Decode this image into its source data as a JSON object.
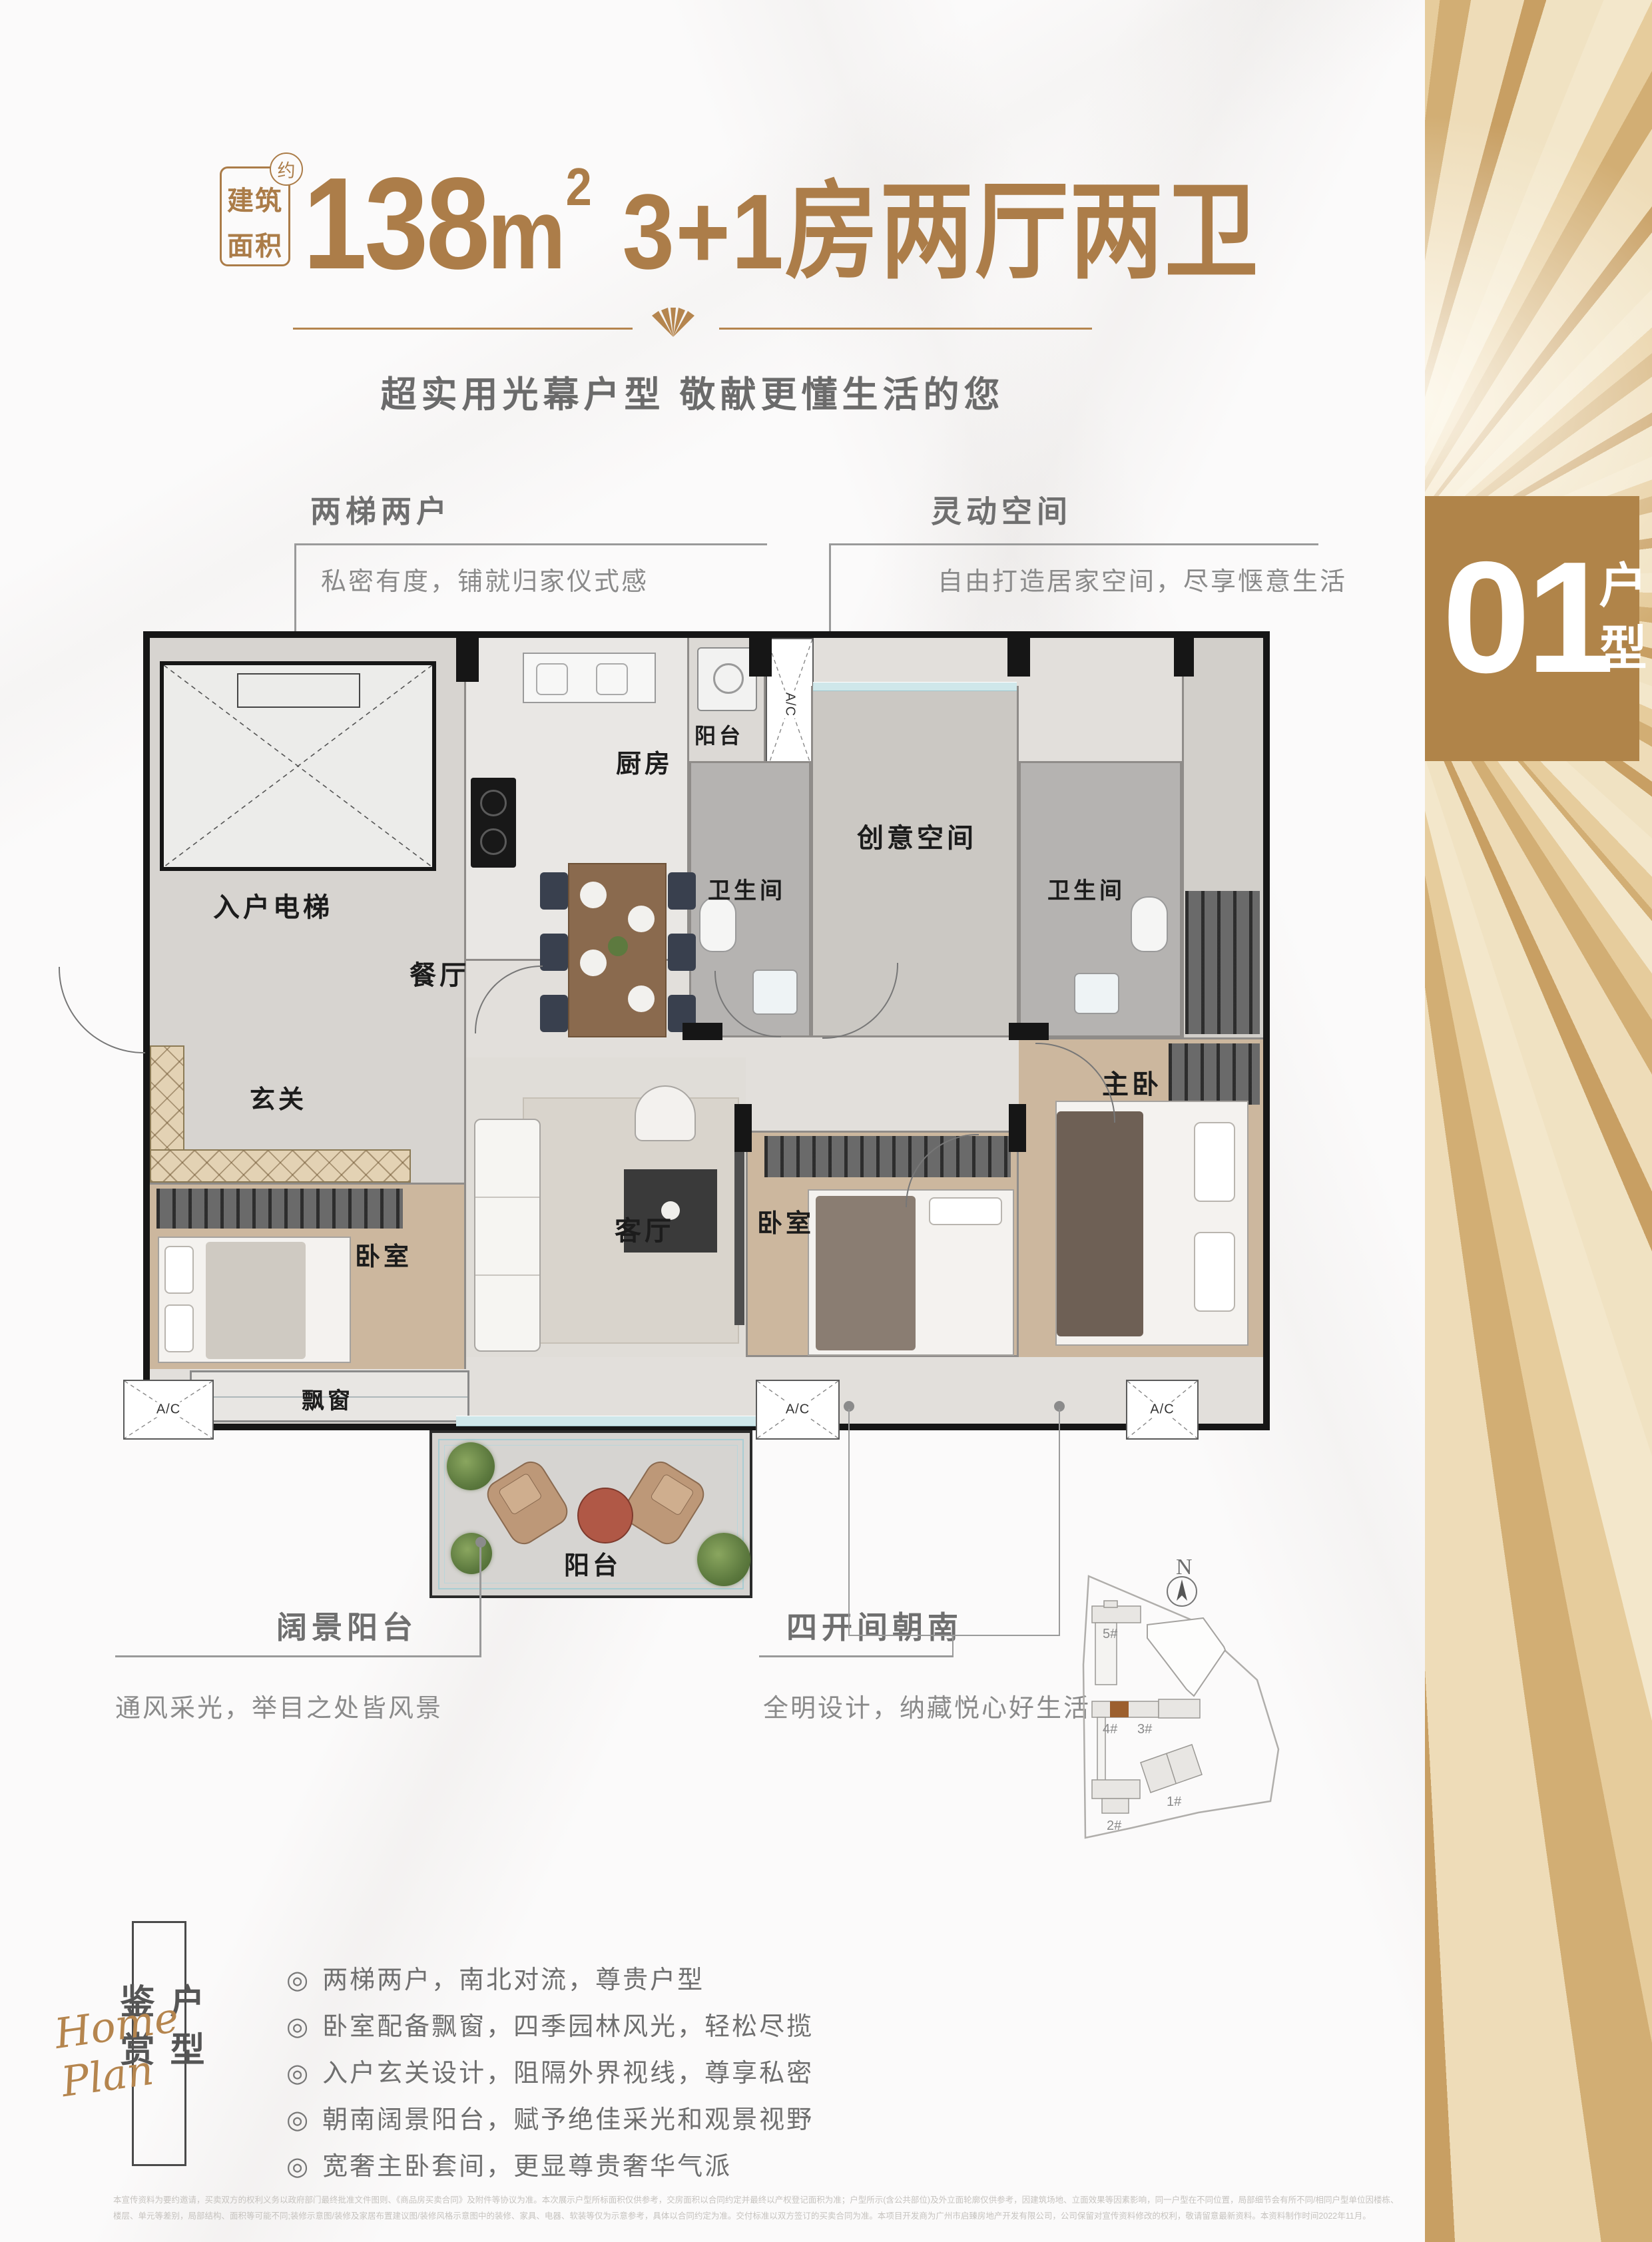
{
  "colors": {
    "accent": "#ab7c48",
    "tag_bg": "#b08449",
    "callout_title": "#6f6f6f",
    "callout_desc": "#8a8a8a",
    "site_highlight": "#9c5f2e",
    "wall": "#161616"
  },
  "header": {
    "badge_line1": "建筑",
    "badge_line2": "面积",
    "badge_approx": "约",
    "area_number": "138",
    "area_unit": "m",
    "area_sup": "2",
    "layout_text": "3+1房两厅两卫",
    "subtitle": "超实用光幕户型 敬献更懂生活的您"
  },
  "callouts": {
    "elevator": {
      "title": "两梯两户",
      "desc": "私密有度，铺就归家仪式感"
    },
    "flex": {
      "title": "灵动空间",
      "desc": "自由打造居家空间，尽享惬意生活"
    },
    "view_balcony": {
      "title": "阔景阳台",
      "desc": "通风采光，举目之处皆风景"
    },
    "south": {
      "title": "四开间朝南",
      "desc": "全明设计，纳藏悦心好生活"
    }
  },
  "plan": {
    "rooms": {
      "entrance_elevator": "入户电梯",
      "kitchen": "厨房",
      "balcony": "阳台",
      "bathroom": "卫生间",
      "creative": "创意空间",
      "foyer": "玄关",
      "dining": "餐厅",
      "living": "客厅",
      "bedroom": "卧室",
      "master": "主卧",
      "bay_window": "飘窗",
      "ac": "A/C"
    }
  },
  "site_plan": {
    "north": "N",
    "buildings": [
      "5#",
      "4#",
      "3#",
      "2#",
      "1#"
    ]
  },
  "unit_tag": {
    "number": "01",
    "label": "户型"
  },
  "review": {
    "vertical_title": "户型鉴赏",
    "script_text": "Home Plan",
    "bullet_char": "◎",
    "items": [
      "两梯两户，南北对流，尊贵户型",
      "卧室配备飘窗，四季园林风光，轻松尽揽",
      "入户玄关设计，阻隔外界视线，尊享私密",
      "朝南阔景阳台，赋予绝佳采光和观景视野",
      "宽奢主卧套间，更显尊贵奢华气派"
    ]
  },
  "disclaimer": {
    "line1": "本宣传资料为要约邀请，买卖双方的权利义务以政府部门最终批准文件图则、《商品房买卖合同》及附件等协议为准。本次展示户型所标面积仅供参考，交房面积以合同约定并最终以产权登记面积为准；户型所示(含公共部位)及外立面轮廓仅供参考，因建筑场地、立面效果等因素影响，同一户型在不同位置，局部细节会有所不同/相同户型单位因楼栋、",
    "line2": "楼层、单元等差别，局部结构、面积等可能不同;装修示意图/装修及家居布置建议图/装修风格示意图中的装修、家具、电器、软装等仅为示意参考，具体以合同约定为准。交付标准以双方签订的买卖合同为准。本项目开发商为广州市启臻房地产开发有限公司，公司保留对宣传资料修改的权利，敬请留意最新资料。本资料制作时间2022年11月。"
  }
}
